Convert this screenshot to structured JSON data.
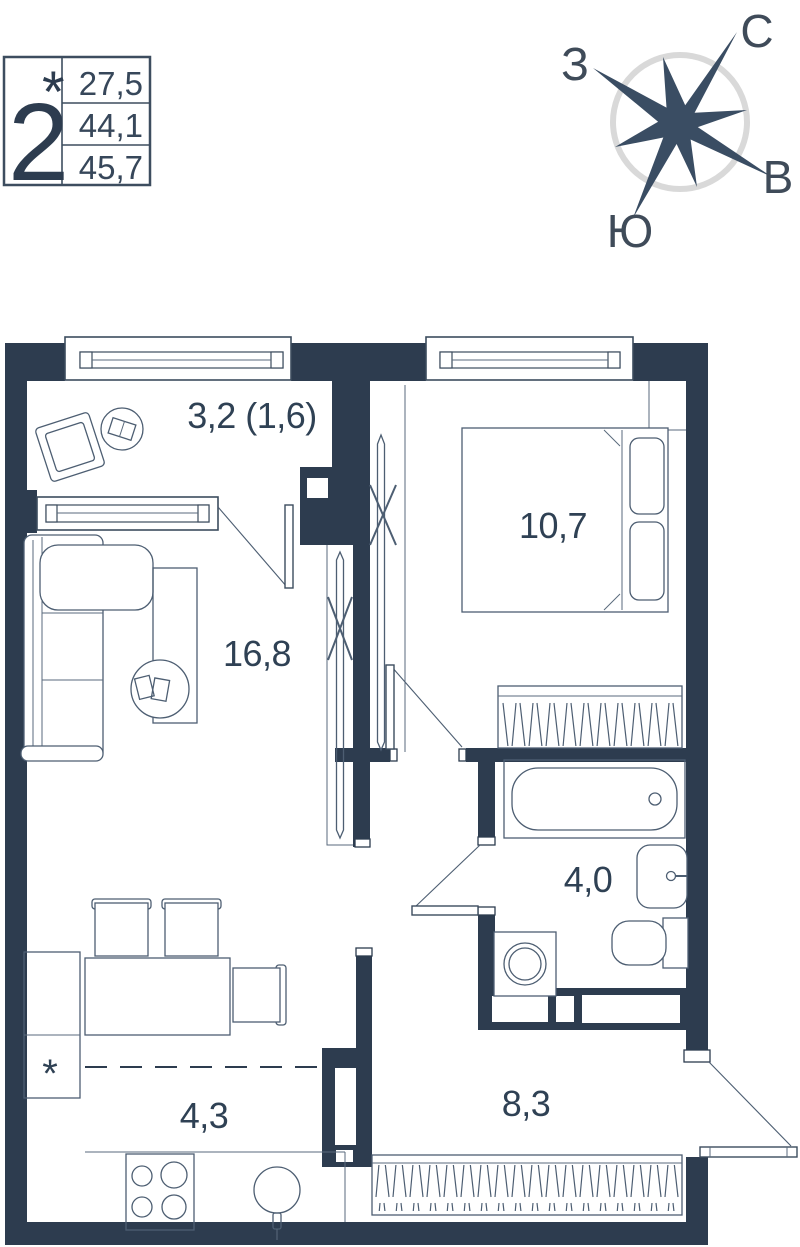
{
  "info_box": {
    "room_count": "2",
    "asterisk": "*",
    "areas": [
      "27,5",
      "44,1",
      "45,7"
    ]
  },
  "compass": {
    "north": "С",
    "east": "В",
    "south": "Ю",
    "west": "З"
  },
  "rooms": {
    "balcony": "3,2 (1,6)",
    "bedroom": "10,7",
    "living_room": "16,8",
    "bathroom": "4,0",
    "kitchen": "4,3",
    "hallway": "8,3"
  },
  "markers": {
    "kitchen_asterisk": "*"
  },
  "colors": {
    "wall": "#2d3c4f",
    "furniture_line": "#4d5e72",
    "label_text": "#2f4154",
    "compass_ring": "#d9d9d9",
    "compass_star": "#3a4d63"
  }
}
